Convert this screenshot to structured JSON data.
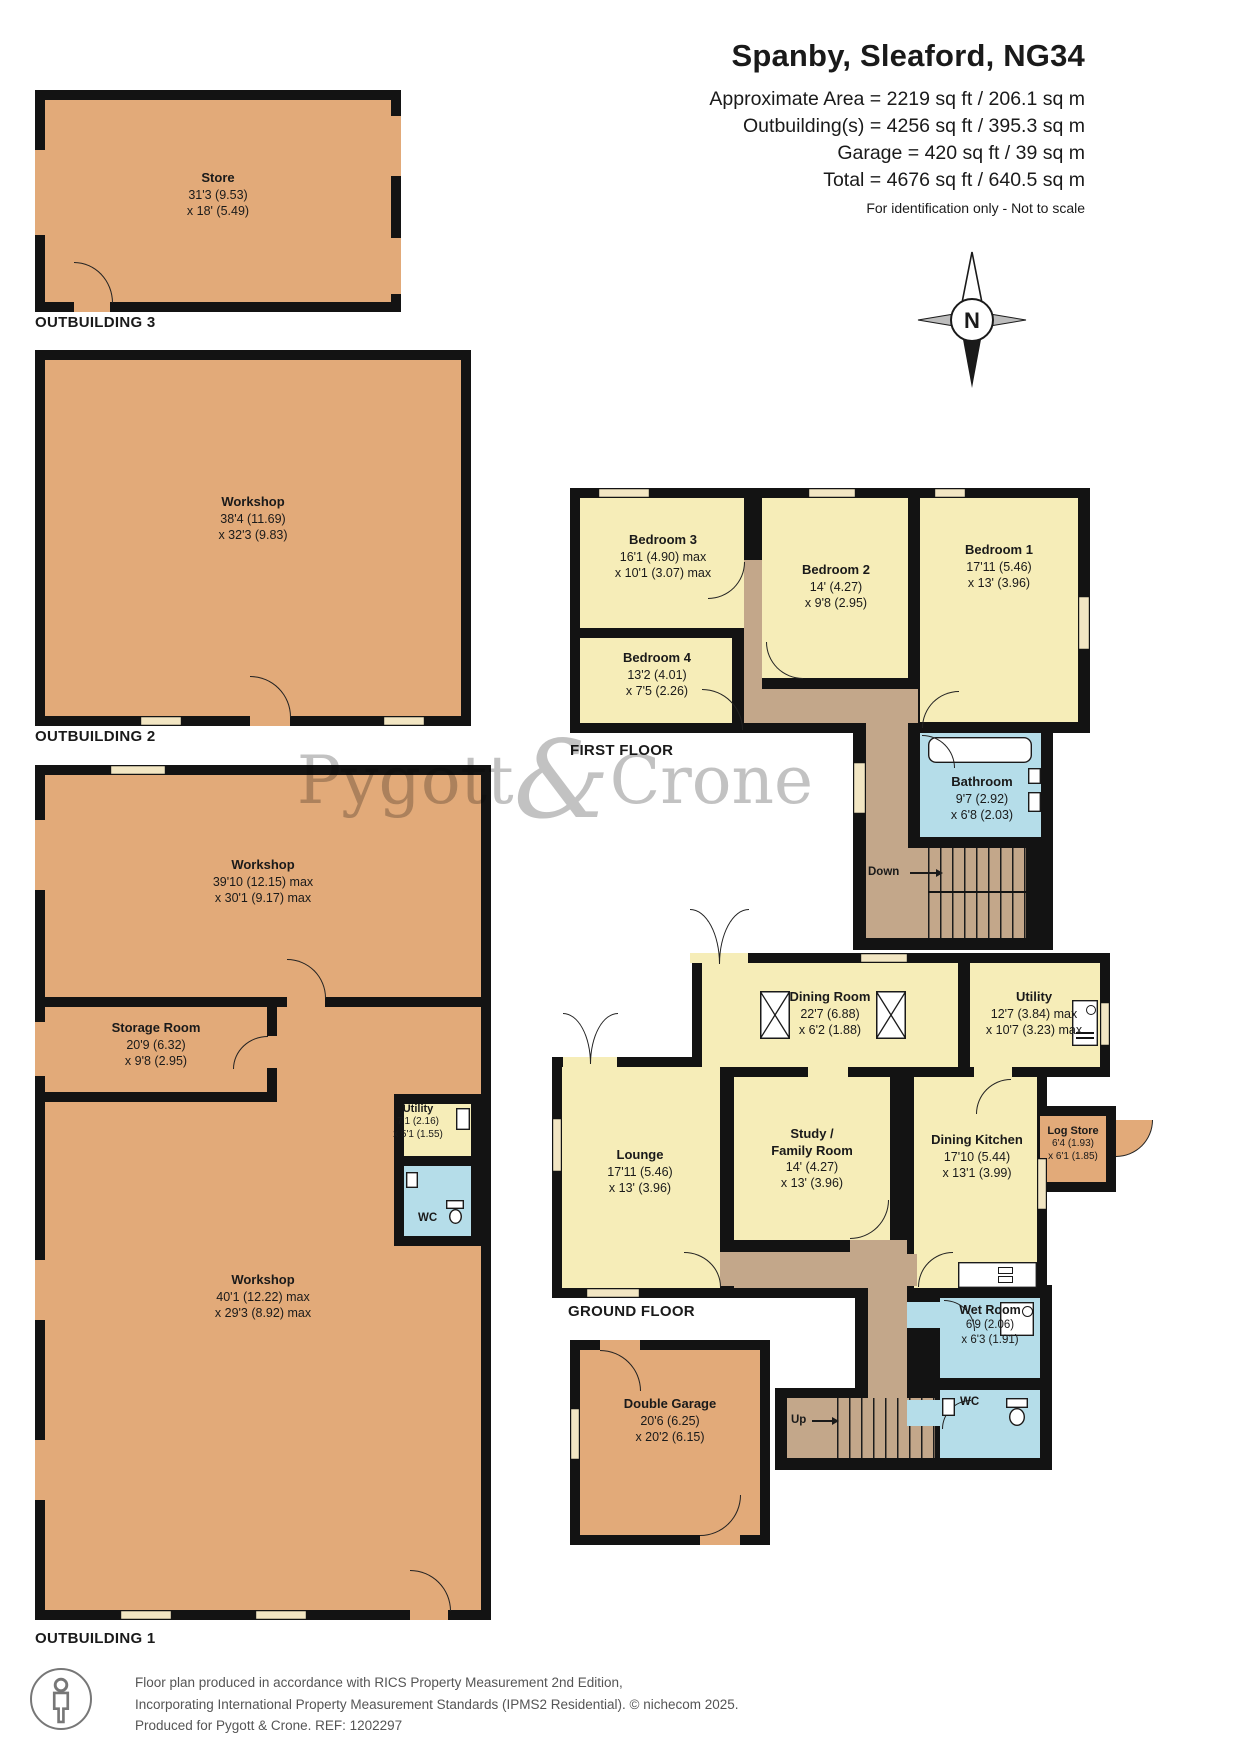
{
  "header": {
    "title": "Spanby, Sleaford, NG34",
    "line1": "Approximate Area = 2219 sq ft / 206.1 sq m",
    "line2": "Outbuilding(s) = 4256 sq ft / 395.3 sq m",
    "line3": "Garage = 420 sq ft / 39 sq m",
    "line4": "Total = 4676 sq ft / 640.5 sq m",
    "note": "For identification only - Not to scale"
  },
  "compass": {
    "n": "N"
  },
  "watermark": {
    "p1": "Pygott",
    "amp": "&",
    "p2": "Crone"
  },
  "floors": {
    "first": "FIRST FLOOR",
    "ground": "GROUND FLOOR",
    "ob1": "OUTBUILDING 1",
    "ob2": "OUTBUILDING 2",
    "ob3": "OUTBUILDING 3"
  },
  "stairs": {
    "down": "Down",
    "up": "Up"
  },
  "rooms": {
    "store": {
      "name": "Store",
      "d1": "31'3 (9.53)",
      "d2": "x 18' (5.49)"
    },
    "ob2_workshop": {
      "name": "Workshop",
      "d1": "38'4 (11.69)",
      "d2": "x 32'3 (9.83)"
    },
    "ob1_workshop_top": {
      "name": "Workshop",
      "d1": "39'10 (12.15) max",
      "d2": "x 30'1 (9.17) max"
    },
    "ob1_storage": {
      "name": "Storage Room",
      "d1": "20'9 (6.32)",
      "d2": "x 9'8 (2.95)"
    },
    "ob1_workshop_bottom": {
      "name": "Workshop",
      "d1": "40'1 (12.22) max",
      "d2": "x 29'3 (8.92) max"
    },
    "ob1_utility": {
      "name": "Utility",
      "d1": "7'1 (2.16)",
      "d2": "x 5'1 (1.55)"
    },
    "ob1_wc": {
      "name": "WC"
    },
    "bedroom1": {
      "name": "Bedroom 1",
      "d1": "17'11 (5.46)",
      "d2": "x 13' (3.96)"
    },
    "bedroom2": {
      "name": "Bedroom 2",
      "d1": "14' (4.27)",
      "d2": "x 9'8 (2.95)"
    },
    "bedroom3": {
      "name": "Bedroom 3",
      "d1": "16'1 (4.90) max",
      "d2": "x 10'1 (3.07) max"
    },
    "bedroom4": {
      "name": "Bedroom 4",
      "d1": "13'2 (4.01)",
      "d2": "x 7'5 (2.26)"
    },
    "bathroom": {
      "name": "Bathroom",
      "d1": "9'7 (2.92)",
      "d2": "x 6'8 (2.03)"
    },
    "dining_room": {
      "name": "Dining Room",
      "d1": "22'7 (6.88)",
      "d2": "x 6'2 (1.88)"
    },
    "utility": {
      "name": "Utility",
      "d1": "12'7 (3.84) max",
      "d2": "x 10'7 (3.23) max"
    },
    "lounge": {
      "name": "Lounge",
      "d1": "17'11 (5.46)",
      "d2": "x 13' (3.96)"
    },
    "study": {
      "name1": "Study /",
      "name2": "Family Room",
      "d1": "14' (4.27)",
      "d2": "x 13' (3.96)"
    },
    "dining_kitchen": {
      "name": "Dining Kitchen",
      "d1": "17'10 (5.44)",
      "d2": "x 13'1 (3.99)"
    },
    "log_store": {
      "name": "Log Store",
      "d1": "6'4 (1.93)",
      "d2": "x 6'1 (1.85)"
    },
    "wet_room": {
      "name": "Wet Room",
      "d1": "6'9 (2.06)",
      "d2": "x 6'3 (1.91)"
    },
    "wc": {
      "name": "WC"
    },
    "garage": {
      "name": "Double Garage",
      "d1": "20'6 (6.25)",
      "d2": "x 20'2 (6.15)"
    }
  },
  "footer": {
    "line1": "Floor plan produced in accordance with RICS Property Measurement 2nd Edition,",
    "line2": "Incorporating International Property Measurement Standards (IPMS2 Residential).  © nichecom 2025.",
    "line3": "Produced for Pygott & Crone.   REF:  1202297"
  },
  "colors": {
    "wall": "#131313",
    "outbuilding_fill": "#e2aa79",
    "room_fill": "#f6edb8",
    "hall_fill": "#c3a78a",
    "wet_fill": "#b5dde9",
    "window_fill": "#f2e6c3",
    "watermark": "#8f8f8f",
    "footer_text": "#555555"
  }
}
